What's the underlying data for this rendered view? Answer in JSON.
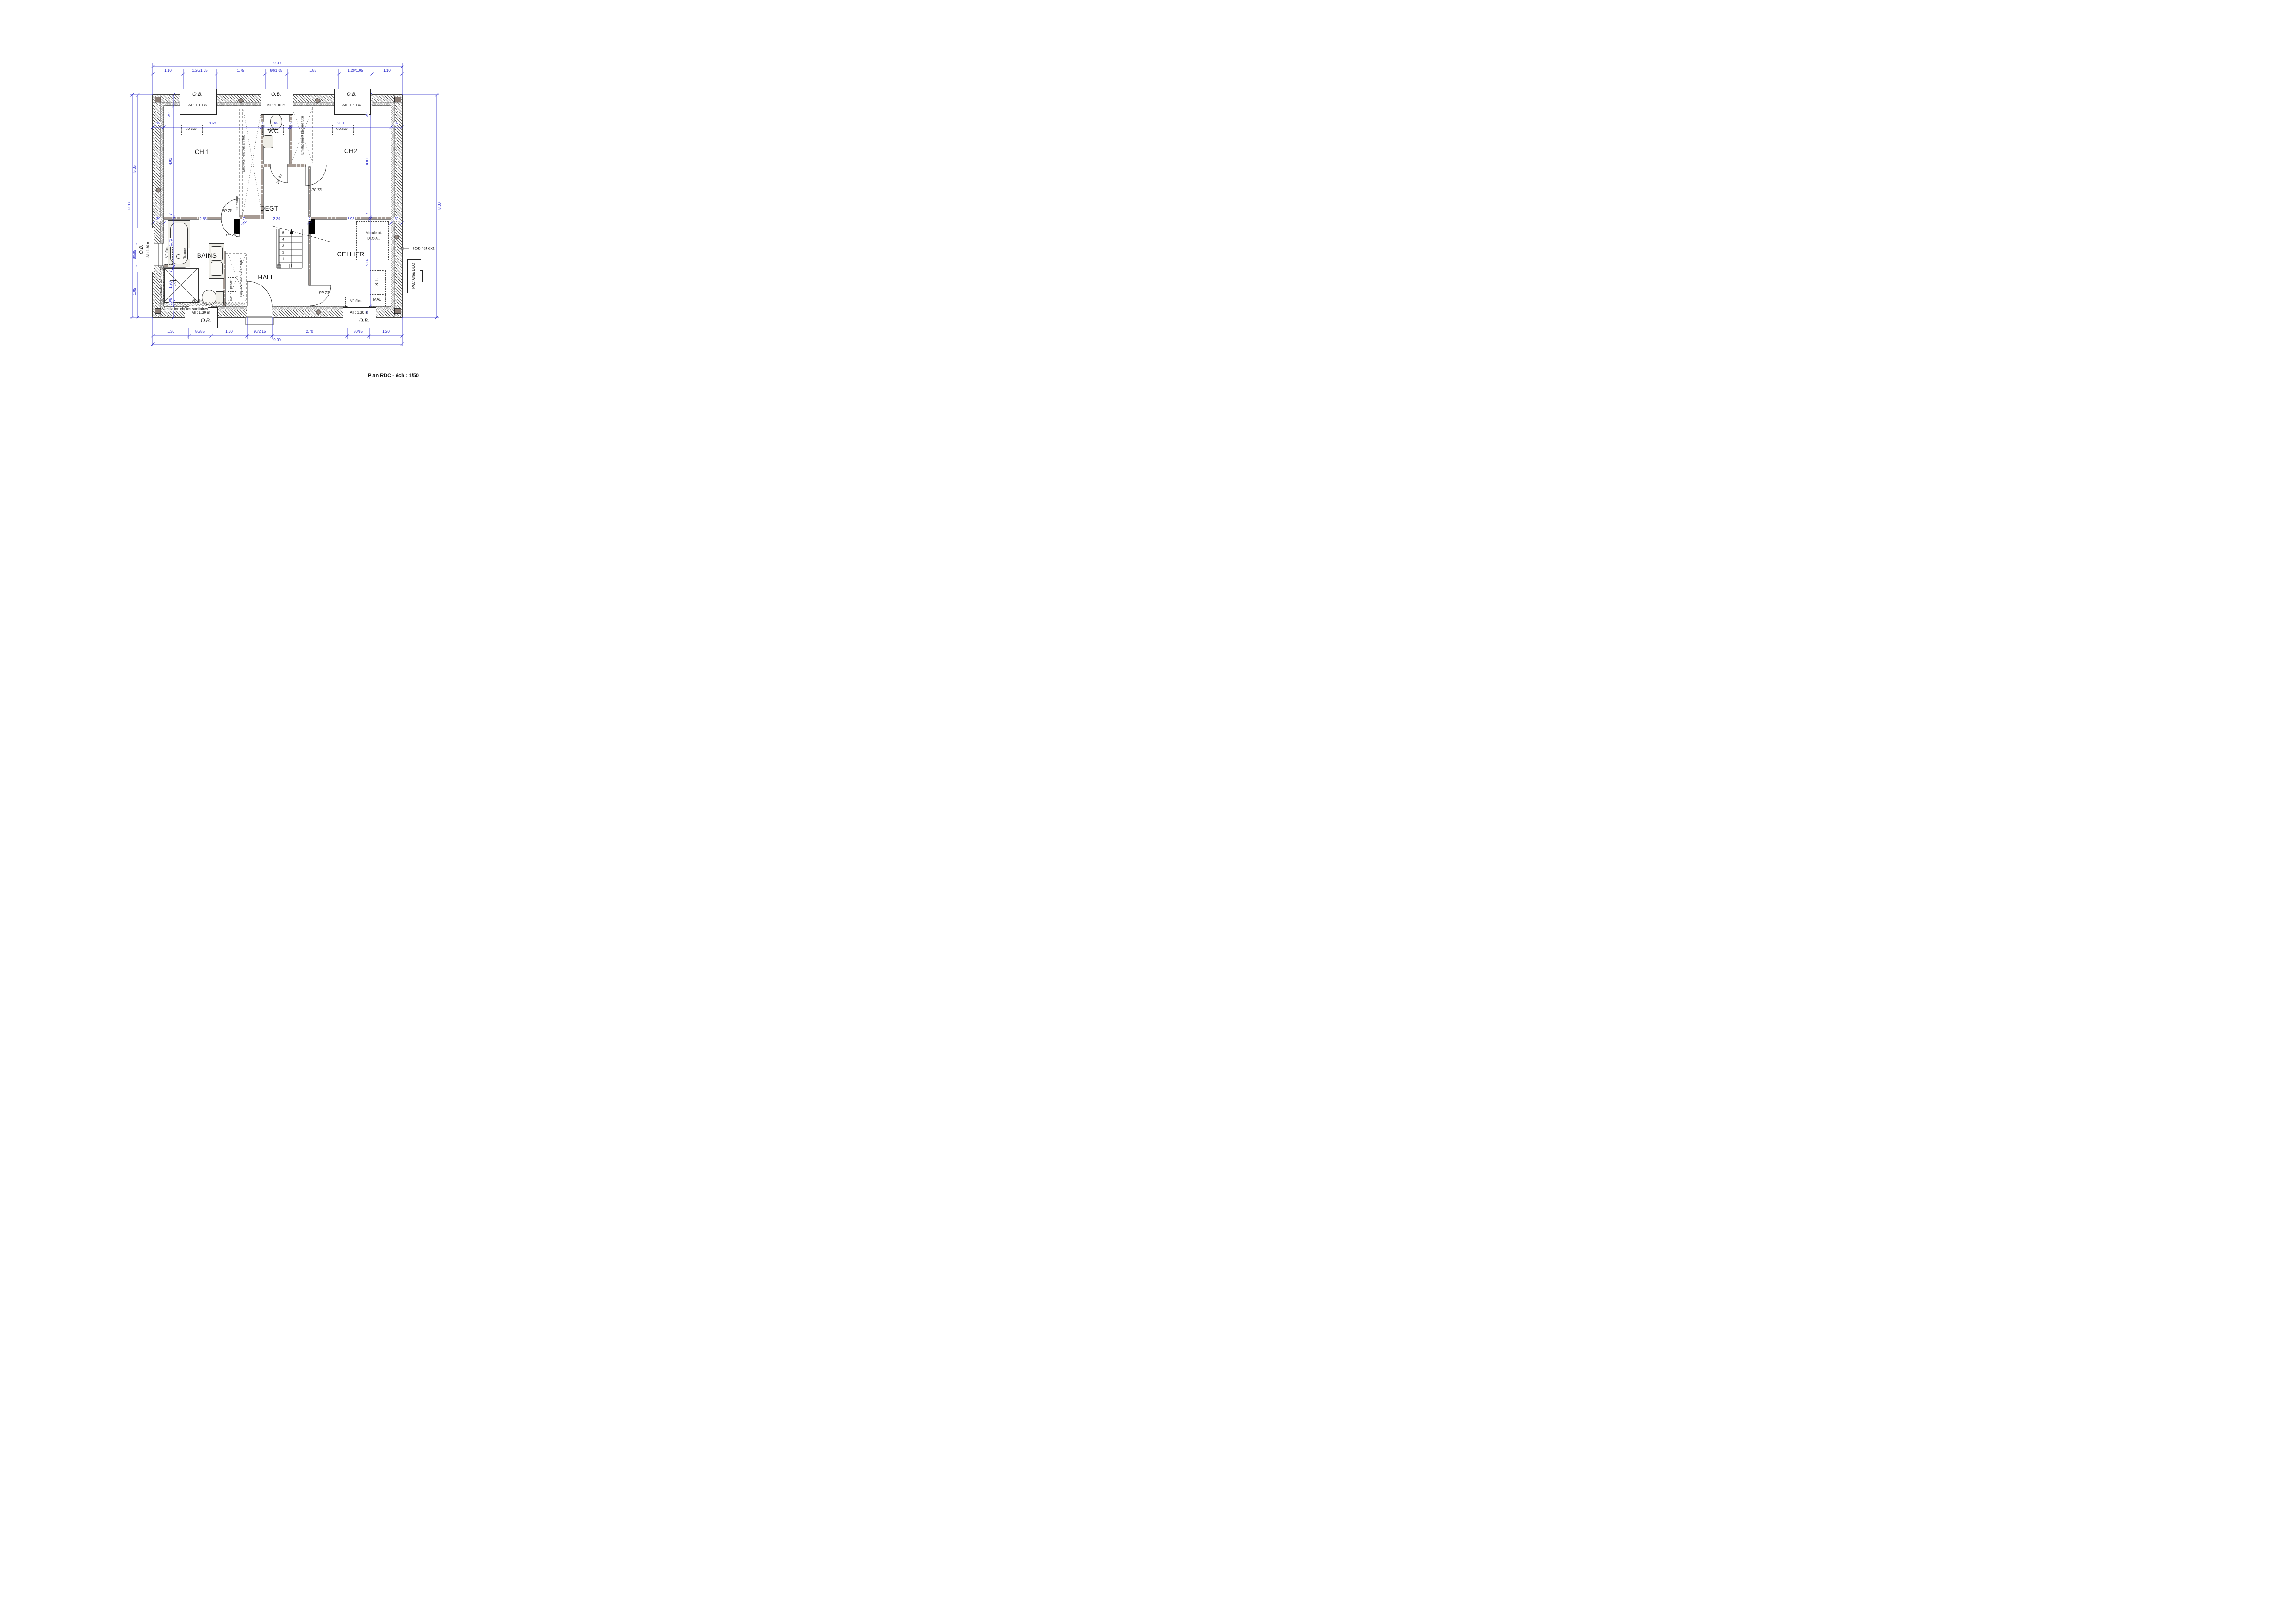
{
  "title": "Plan RDC - éch : 1/50",
  "rooms": {
    "ch1": "CH:1",
    "wc": "WC",
    "ch2": "CH2",
    "degt": "DEGT",
    "bains": "BAINS",
    "hall": "HALL",
    "cellier": "CELLIER"
  },
  "dims": {
    "top_total": "9.00",
    "bottom_total": "9.00",
    "left_total": "8.00",
    "right_total": "8.00",
    "top": [
      "1.10",
      "1.20/1.05",
      "1.75",
      "80/1.05",
      "1.85",
      "1.20/1.05",
      "1.10"
    ],
    "bottom": [
      "1.30",
      "80/85",
      "1.30",
      "90/2.15",
      "2.70",
      "80/85",
      "1.20"
    ],
    "left": [
      "5.35",
      "80/85",
      "1.85"
    ],
    "int_top": [
      "39",
      "3.52",
      "7",
      "95",
      "7",
      "3.61",
      "39"
    ],
    "int_mid": [
      "39",
      "2.85",
      "7",
      "2.30",
      "7",
      "2.93",
      "39"
    ],
    "int_left": [
      "39",
      "4.01",
      "7",
      "1.71",
      "7",
      "1.20",
      "10/6"
    ],
    "int_right": [
      "39",
      "4.01",
      "7",
      "3.14",
      "39"
    ]
  },
  "windows": {
    "ob": "O.B.",
    "all_110": "All : 1.10 m",
    "all_130": "All : 1.30 m"
  },
  "labels": {
    "vr_elec": "VR élec.",
    "pp73": "PP 73",
    "pp63": "PP 63",
    "placard": "Emplacement placard futur",
    "non_visible": "non visible",
    "vent_fosse": "Ventilation de fosse",
    "vent_chutes": "Ventilation chûtes sanitaires",
    "trappe": "Trappe",
    "robinet": "Robinet ext.",
    "pac": "PAC Alféa DUO",
    "module_1": "Module int.",
    "module_2": "DUO A.I.",
    "sl": "S.L.",
    "mal": "MAL",
    "telecom": "Telecom",
    "edf": "EDF"
  },
  "stairs": {
    "steps": [
      "1",
      "2",
      "3",
      "4",
      "5"
    ]
  },
  "colors": {
    "dim_blue": "#2020c8",
    "partition": "#a79b94",
    "post": "#000000",
    "fixture": "#f0efe9",
    "hatch": "#4a4a4a"
  }
}
